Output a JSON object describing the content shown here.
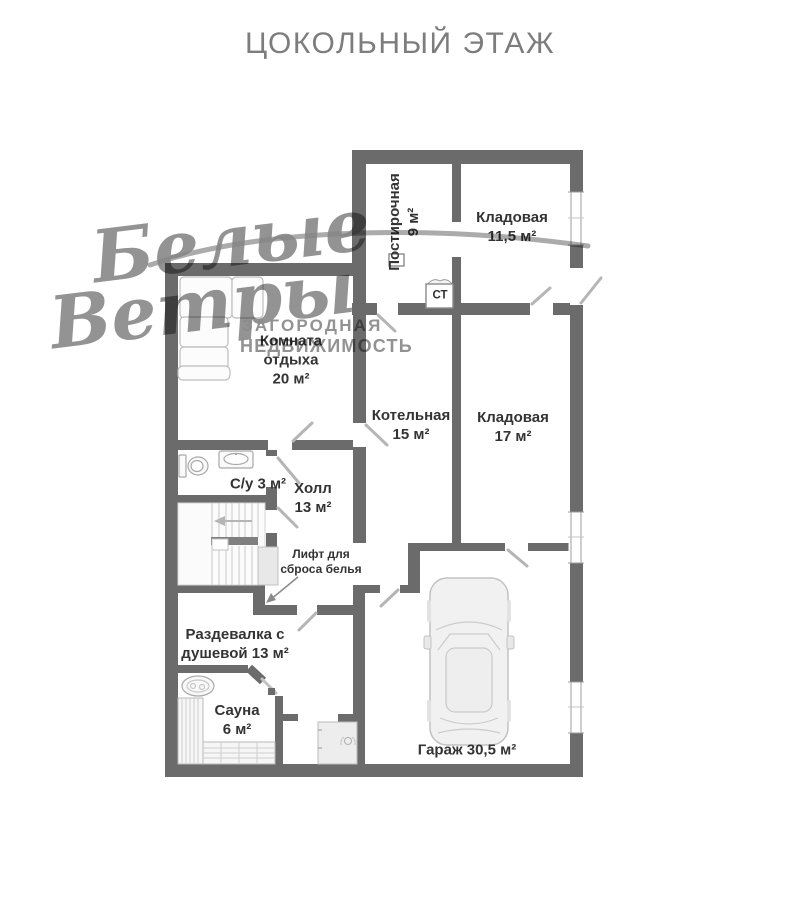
{
  "title": "ЦОКОЛЬНЫЙ ЭТАЖ",
  "watermark": {
    "script_line1": "Белые",
    "script_line2": "Ветры",
    "tagline_line1": "ЗАГОРОДНАЯ",
    "tagline_line2": "НЕДВИЖИМОСТЬ"
  },
  "rooms": {
    "laundry": {
      "line1": "Постирочная",
      "line2": "9 м²"
    },
    "pantry_upper": {
      "line1": "Кладовая",
      "line2": "11,5 м²"
    },
    "lounge": {
      "line1": "Комната",
      "line2": "отдыха",
      "line3": "20 м²"
    },
    "boiler": {
      "line1": "Котельная",
      "line2": "15 м²"
    },
    "pantry_middle": {
      "line1": "Кладовая",
      "line2": "17 м²"
    },
    "bathroom": {
      "label": "С/у 3 м²"
    },
    "hall": {
      "line1": "Холл",
      "line2": "13 м²"
    },
    "laundry_chute": {
      "line1": "Лифт для",
      "line2": "сброса белья"
    },
    "dressing": {
      "line1": "Раздевалка с",
      "line2": "душевой 13 м²"
    },
    "sauna": {
      "line1": "Сауна",
      "line2": "6 м²"
    },
    "garage": {
      "label": "Гараж 30,5 м²"
    },
    "washer": {
      "label": "СТ"
    }
  },
  "colors": {
    "wall": "#6b6b6b",
    "label_text": "#333333",
    "title_text": "#7d7d7d",
    "watermark": "#8c8c8c",
    "fixture_stroke": "#b5b5b5",
    "fixture_fill": "#f2f2f2"
  }
}
